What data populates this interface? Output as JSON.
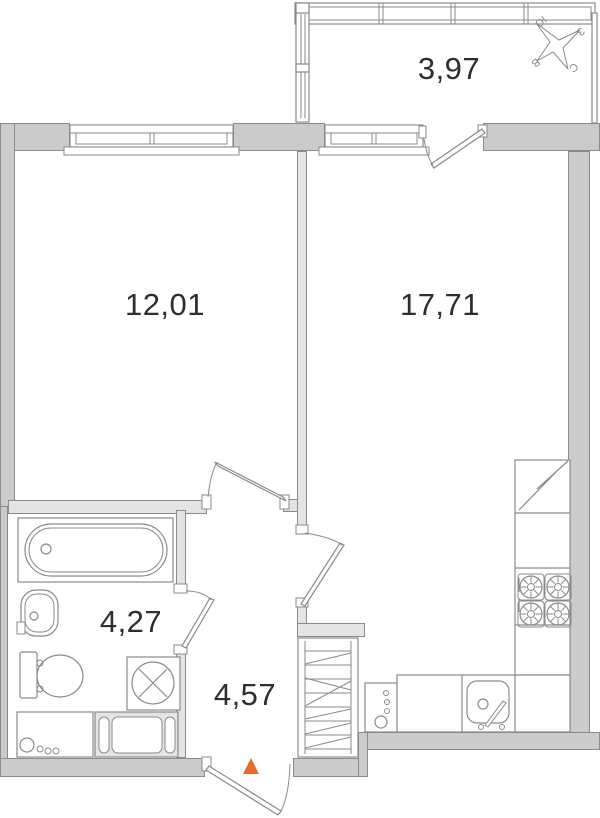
{
  "rooms": [
    {
      "name": "balcony",
      "area_label": "3,97"
    },
    {
      "name": "room",
      "area_label": "12,01"
    },
    {
      "name": "kitchen-living-room",
      "area_label": "17,71"
    },
    {
      "name": "bathroom",
      "area_label": "4,27"
    },
    {
      "name": "hallway",
      "area_label": "4,57"
    }
  ],
  "compass": {
    "south": "Ю",
    "west": "З",
    "east": "В",
    "north": "С"
  },
  "colors": {
    "exterior_wall": "#cbcbcb",
    "interior_wall": "#e4e4e4",
    "line": "#8a8a8a",
    "text": "#2e2e2e",
    "entrance_marker": "#e96b2d"
  },
  "fixtures": [
    "balcony-glazing",
    "window",
    "balcony-door",
    "bathtub",
    "wash-basin",
    "toilet",
    "washing-machine",
    "bathroom-cabinet",
    "bath-mat",
    "wardrobe",
    "refrigerator",
    "stove",
    "kitchen-counter",
    "kitchen-sink",
    "appliance-panel",
    "entrance-arrow",
    "compass-rose"
  ]
}
